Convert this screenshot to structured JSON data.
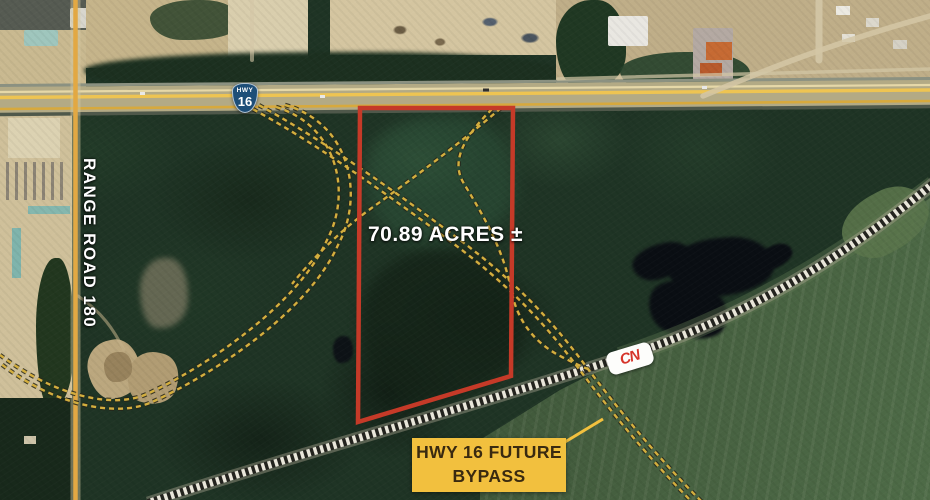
{
  "map": {
    "annotations": {
      "acreage": "70.89 ACRES ±",
      "range_road": "RANGE ROAD 180",
      "highway_shield": {
        "top": "HWY",
        "number": "16"
      },
      "railway_logo": "CN",
      "bypass_label": {
        "line1": "HWY 16 FUTURE",
        "line2": "BYPASS"
      }
    },
    "icons": {
      "highway_shield": "hwy-16-shield-icon",
      "railway_logo": "cn-railway-logo"
    },
    "colors": {
      "parcel_outline": "#c53a28",
      "bypass_dash": "#d3ae3e",
      "bypass_label_bg": "#f2c03e",
      "bypass_label_text": "#3a2a10",
      "highway_line": "#eec452",
      "range_road_line": "#e2a843",
      "shield_bg": "#1d4e78",
      "cn_red": "#d6342a",
      "rail_dark": "#23231e",
      "rail_light": "#e9e6da"
    }
  }
}
